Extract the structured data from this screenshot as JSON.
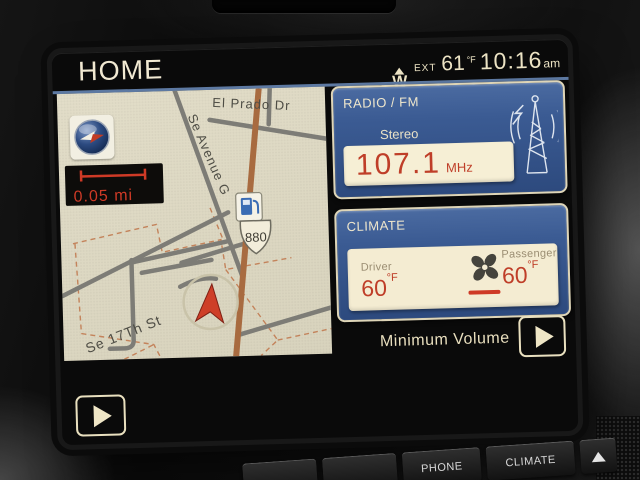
{
  "status_bar": {
    "title": "HOME",
    "compass_direction": "W",
    "ext_label": "EXT",
    "outside_temp": "61",
    "temp_unit": "°F",
    "time": "10:16",
    "meridiem": "am"
  },
  "map_panel": {
    "scale_label": "0.05 mi",
    "highway_shield": "880",
    "streets": {
      "el_prado": "El Prado Dr",
      "avenue_g": "Se Avenue G",
      "seventeenth_st": "Se 17Th St"
    }
  },
  "radio_panel": {
    "title": "RADIO / FM",
    "mode": "Stereo",
    "frequency": "107.1",
    "frequency_unit": "MHz"
  },
  "climate_panel": {
    "title": "CLIMATE",
    "driver_label": "Driver",
    "driver_temp": "60",
    "driver_temp_unit": "°F",
    "passenger_label": "Passenger",
    "passenger_temp": "60",
    "passenger_temp_unit": "°F"
  },
  "bottom_bar": {
    "status_text": "Minimum Volume"
  },
  "hard_buttons": {
    "phone": "PHONE",
    "climate": "CLIMATE"
  },
  "colors": {
    "accent_red": "#bf3e28",
    "panel_blue": "#3b5b93",
    "cream_text": "#ece3c4",
    "map_bg": "#ddd8c3",
    "highway_orange": "#a86b40"
  }
}
